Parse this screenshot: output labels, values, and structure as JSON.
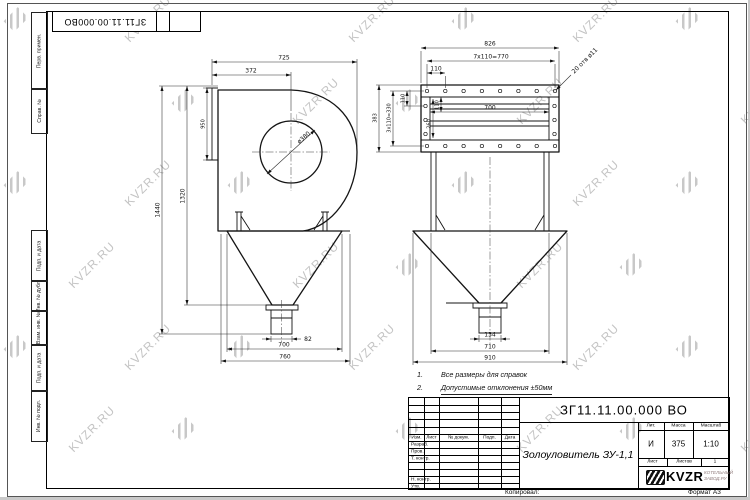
{
  "page": {
    "watermark": "KVZR.RU",
    "copied": "Копировал:",
    "format": "Формат А3"
  },
  "corner_stamp": "ЗГ11.11.00.000ВО",
  "margin": {
    "perv": "Перв. примен.",
    "sprav": "Справ. №",
    "podp1": "Подп. и дата",
    "dubl": "Инв. № дубл.",
    "vzam": "Взам. инв. №",
    "podp2": "Подп. и дата",
    "podl": "Инв. № подл."
  },
  "notes": {
    "n1_num": "1.",
    "n1_text": "Все размеры для справок",
    "n2_num": "2.",
    "n2_text": "Допустимые отклонения ±50мм"
  },
  "left_view": {
    "w725": "725",
    "w372": "372",
    "h950": "950",
    "h1440": "1440",
    "h1320": "1320",
    "dia": "ø380",
    "w82": "82",
    "w700": "700",
    "w760": "760"
  },
  "right_view": {
    "w826": "826",
    "w770": "7x110=770",
    "w110_top": "110",
    "h383": "383",
    "h330": "3x110=330",
    "h110_left": "110",
    "h110_inner": "110",
    "h260": "260",
    "w700_inner": "700",
    "holes_note": "20 отв ø11",
    "w134": "134",
    "w710": "710",
    "w910": "910"
  },
  "title_block": {
    "designation": "ЗГ11.11.00.000 ВО",
    "name": "Золоуловитель ЗУ-1,1",
    "lit_label": "Лит.",
    "mass_label": "Масса",
    "scale_label": "Масштаб",
    "lit": "И",
    "mass": "375",
    "scale": "1:10",
    "sheet_label": "Лист",
    "sheets_label": "Листов",
    "sheets": "1",
    "col_izm": "Изм.",
    "col_list": "Лист",
    "col_doc": "№ докум.",
    "col_podp": "Подп.",
    "col_data": "Дата",
    "row_razrab": "Разраб.",
    "row_prov": "Пров.",
    "row_tkontr": "Т. контр.",
    "row_nkontr": "Н. контр.",
    "row_utv": "Утв.",
    "logo": "KVZR",
    "org1": "КОТЕЛЬНЫЙ",
    "org2": "ЗАВОД.РУ"
  }
}
